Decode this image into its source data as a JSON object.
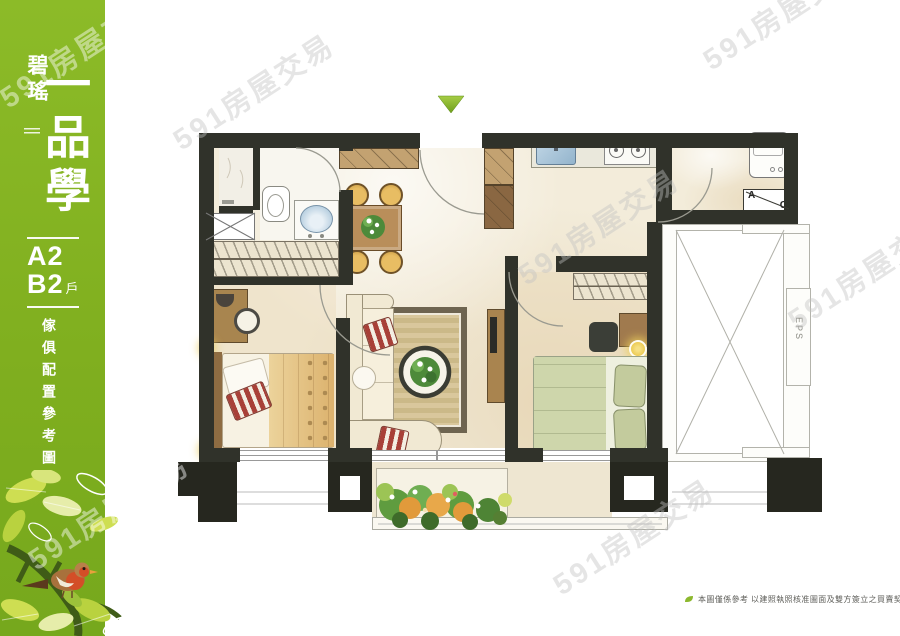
{
  "watermark": {
    "text": "591房屋交易"
  },
  "sidebar": {
    "brand": "碧瑤",
    "project": "一品學",
    "unit_a": "A2",
    "unit_b": "B2",
    "unit_suffix": "戶",
    "caption": "傢俱配置參考圖"
  },
  "plan": {
    "ac_label_a": "A",
    "ac_label_c": "C",
    "eps_label": "EPS"
  },
  "footer": {
    "disclaimer": "本圖僅係參考 以建照執照核准圖面及雙方簽立之買賣契約書為準"
  }
}
